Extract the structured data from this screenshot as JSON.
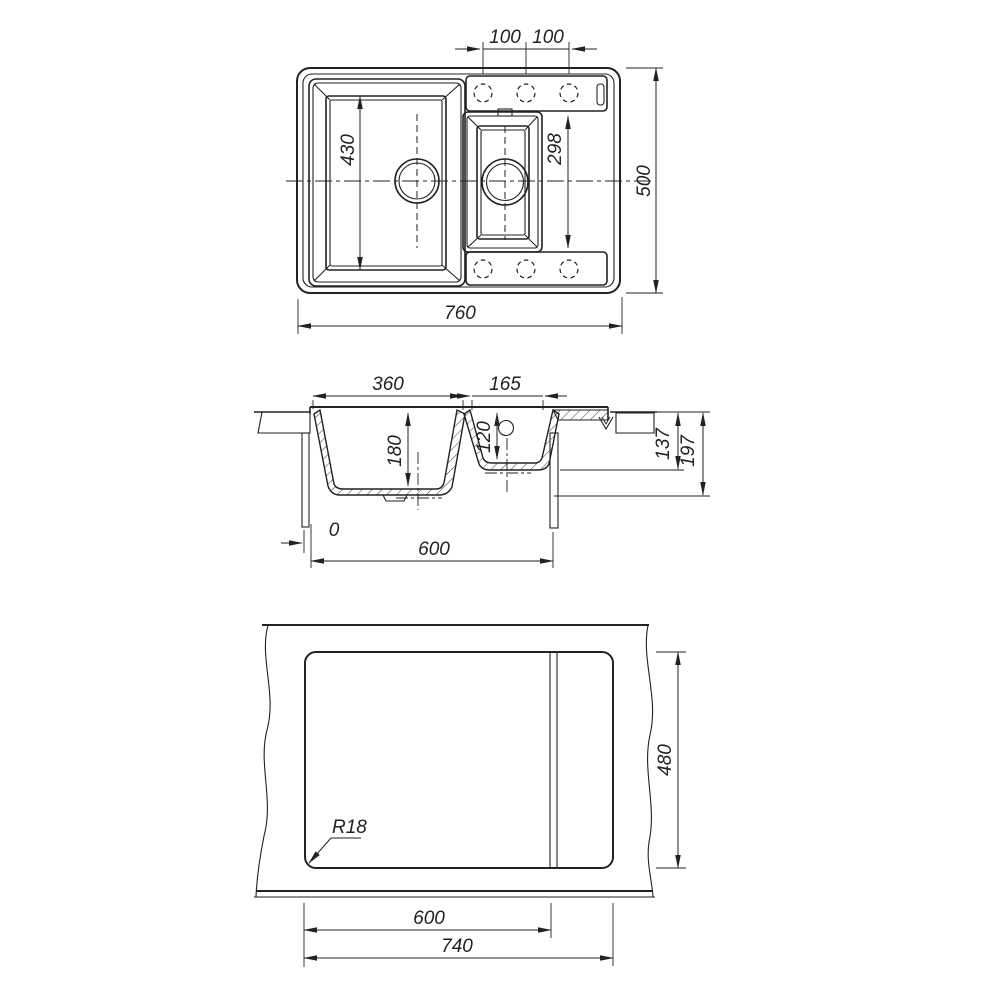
{
  "drawing": {
    "type": "kitchen sink installation drawing",
    "views": [
      "plan",
      "section",
      "worktop cutout"
    ]
  },
  "colors": {
    "line": "#222222",
    "background": "#ffffff"
  },
  "top_view": {
    "dim_hole_pitch_left": "100",
    "dim_hole_pitch_right": "100",
    "dim_main_bowl_length": "430",
    "dim_small_bowl_length": "298",
    "dim_overall_width": "760",
    "dim_overall_depth": "500"
  },
  "section_view": {
    "dim_main_bowl_width": "360",
    "dim_small_bowl_width": "165",
    "dim_main_bowl_depth": "180",
    "dim_small_bowl_depth": "120",
    "dim_rim_to_small_bowl_underside": "137",
    "dim_overall_height": "197",
    "dim_edge_offset": "0",
    "dim_cabinet_width": "600"
  },
  "cutout_view": {
    "dim_cutout_depth": "480",
    "dim_main_section_width": "600",
    "dim_cutout_total_width": "740",
    "label_corner_radius": "R18"
  }
}
